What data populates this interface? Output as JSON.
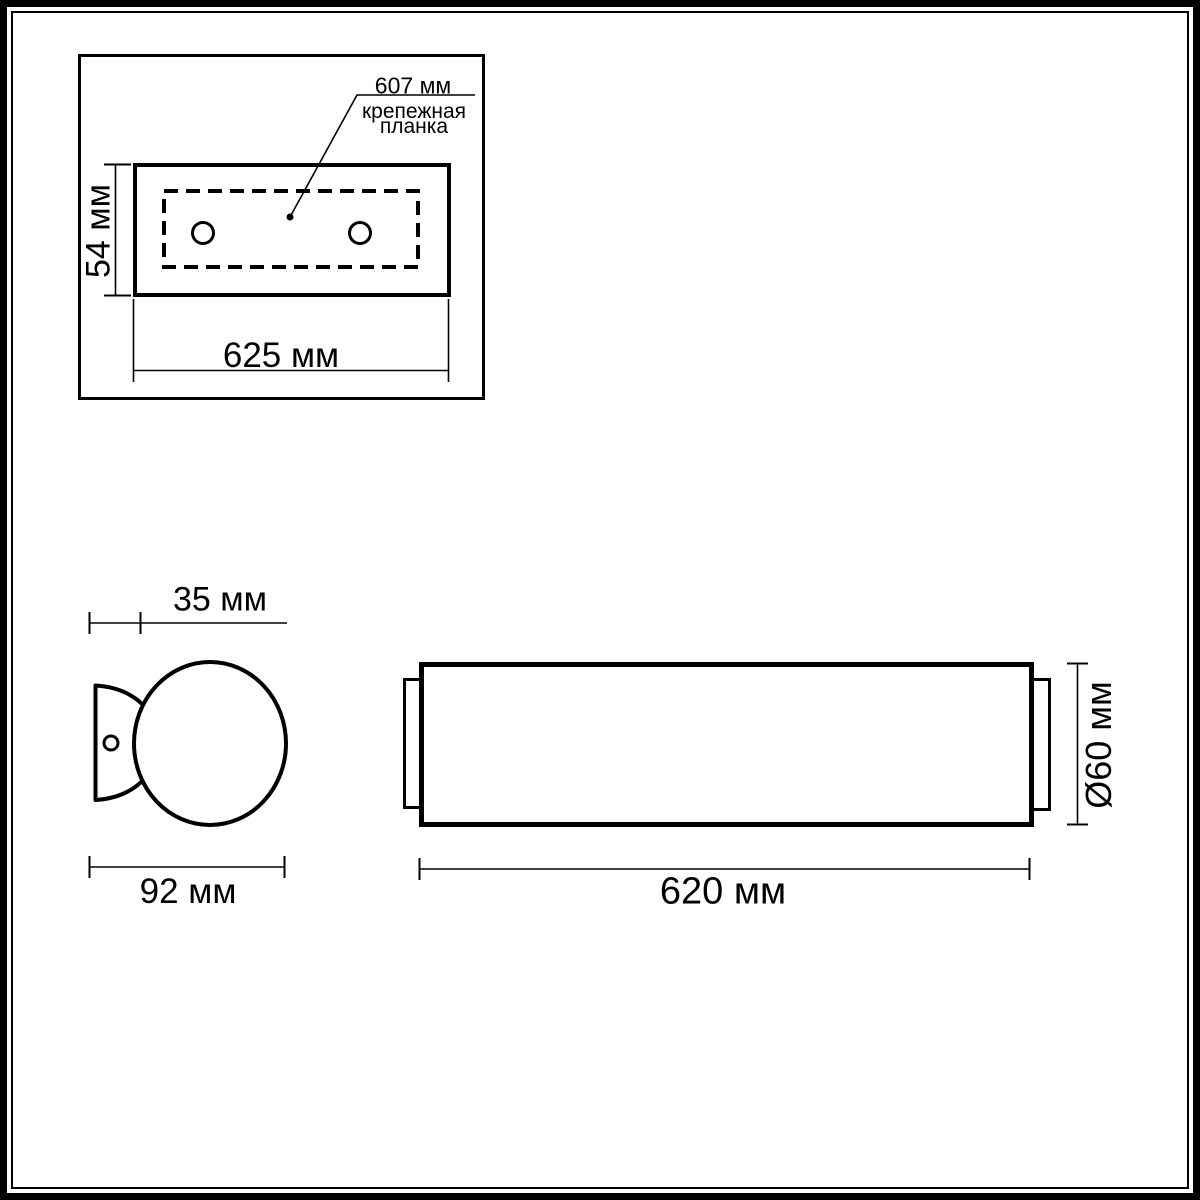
{
  "colors": {
    "line": "#000000",
    "background": "#ffffff",
    "text": "#000000"
  },
  "top_view": {
    "dim_leader_label": "607 мм",
    "caption_line1": "крепежная",
    "caption_line2": "планка",
    "dim_height_label": "54 мм",
    "dim_width_label": "625 мм"
  },
  "side_view": {
    "dim_bracket_depth_label": "35 мм",
    "dim_overall_depth_label": "92 мм"
  },
  "front_view": {
    "dim_length_label": "620 мм",
    "dim_diameter_label": "Ø60 мм"
  }
}
